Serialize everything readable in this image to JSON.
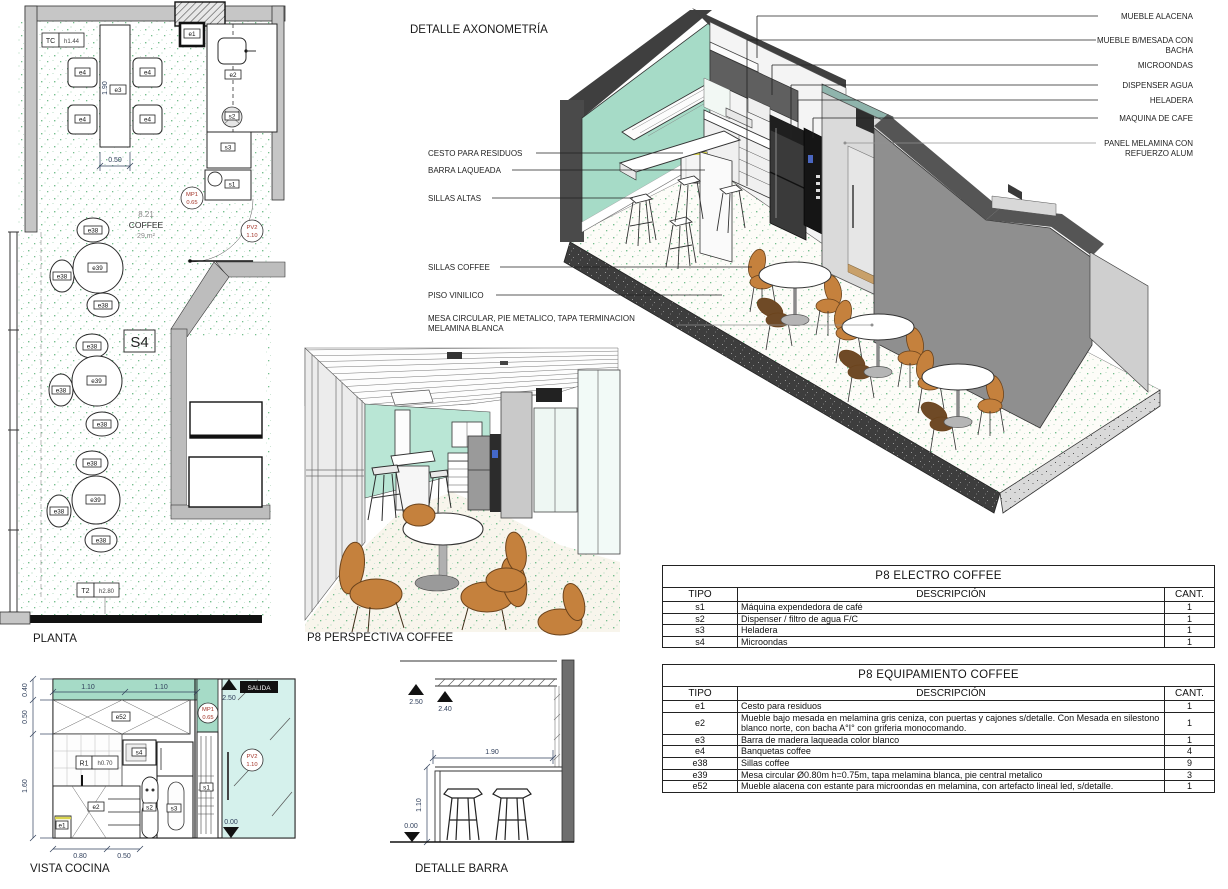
{
  "captions": {
    "axo": "DETALLE AXONOMETRÍA",
    "plan": "PLANTA",
    "persp": "P8 PERSPECTIVA COFFEE",
    "vista": "VISTA COCINA",
    "barra": "DETALLE BARRA"
  },
  "plan": {
    "tc": "TC",
    "tc_h": "h1.44",
    "t2": "T2",
    "t2_h": "h2.80",
    "room_no": "8.21",
    "room_name": "COFFEE",
    "room_area": "29 m²",
    "section": "S4",
    "dim_len": "1.90",
    "dim_wid": "0.50",
    "mp1": "MP1",
    "mp1_h": "0.65",
    "pv2": "PV2",
    "pv2_h": "1.10",
    "e1": "e1",
    "e2": "e2",
    "e3": "e3",
    "e4": "e4",
    "e38": "e38",
    "e39": "e39",
    "s1": "s1",
    "s2": "s2",
    "s3": "s3"
  },
  "axo_labels": {
    "left": [
      "CESTO PARA RESIDUOS",
      "BARRA LAQUEADA",
      "SILLAS ALTAS",
      "SILLAS COFFEE",
      "PISO VINILICO",
      "MESA CIRCULAR, PIE METALICO, TAPA TERMINACION",
      "MELAMINA BLANCA"
    ],
    "right": [
      "MUEBLE ALACENA",
      "MUEBLE B/MESADA CON",
      "BACHA",
      "MICROONDAS",
      "DISPENSER AGUA",
      "HELADERA",
      "MAQUINA DE CAFE",
      "PANEL MELAMINA CON",
      "REFUERZO ALUM"
    ]
  },
  "vista": {
    "d040": "0.40",
    "d050": "0.50",
    "d160": "1.60",
    "d110a": "1.10",
    "d110b": "1.10",
    "d080": "0.80",
    "d050b": "0.50",
    "l250": "2.50",
    "l000": "0.00",
    "e52": "e52",
    "s4": "s4",
    "r1": "R1",
    "r1_h": "h0.70",
    "e2": "e2",
    "e1": "e1",
    "s2": "s2",
    "s3": "s3",
    "s1": "s1",
    "mp1": "MP1",
    "mp1_h": "0.65",
    "pv2": "PV2",
    "pv2_h": "1.10",
    "salida": "SALIDA"
  },
  "barra": {
    "l250": "2.50",
    "l240": "2.40",
    "l000": "0.00",
    "d190": "1.90",
    "d110": "1.10"
  },
  "colors": {
    "mint": "#a6dbc7",
    "mint_light": "#b9e6d5",
    "wall_dark": "#4a4a4a",
    "wall_gray": "#8f8f8f",
    "chair_orange": "#c5813d",
    "chair_brown": "#6f4a26",
    "speckle_green": "#76bf8e",
    "glass_cyan": "#d5f1ec",
    "label_red": "#a33327",
    "dim_navy": "#31405c",
    "wood": "#c8a06a"
  },
  "spec_tables": [
    {
      "title": "P8 ELECTRO COFFEE",
      "headers": [
        "TIPO",
        "DESCRIPCIÓN",
        "CANT."
      ],
      "rows": [
        [
          "s1",
          "Máquina expendedora de café",
          "1"
        ],
        [
          "s2",
          "Dispenser / filtro de agua F/C",
          "1"
        ],
        [
          "s3",
          "Heladera",
          "1"
        ],
        [
          "s4",
          "Microondas",
          "1"
        ]
      ]
    },
    {
      "title": "P8 EQUIPAMIENTO COFFEE",
      "headers": [
        "TIPO",
        "DESCRIPCIÓN",
        "CANT."
      ],
      "rows": [
        [
          "e1",
          "Cesto para residuos",
          "1"
        ],
        [
          "e2",
          "Mueble bajo mesada en melamina gris ceniza, con puertas y cajones s/detalle. Con Mesada en silestono blanco norte, con bacha A°I° con griferia monocomando.",
          "1"
        ],
        [
          "e3",
          "Barra de madera laqueada color blanco",
          "1"
        ],
        [
          "e4",
          "Banquetas coffee",
          "4"
        ],
        [
          "e38",
          "Sillas coffee",
          "9"
        ],
        [
          "e39",
          "Mesa circular Ø0.80m h=0.75m, tapa melamina blanca, pie central metalico",
          "3"
        ],
        [
          "e52",
          "Mueble alacena con estante para microondas en melamina, con artefacto lineal led, s/detalle.",
          "1"
        ]
      ]
    }
  ]
}
